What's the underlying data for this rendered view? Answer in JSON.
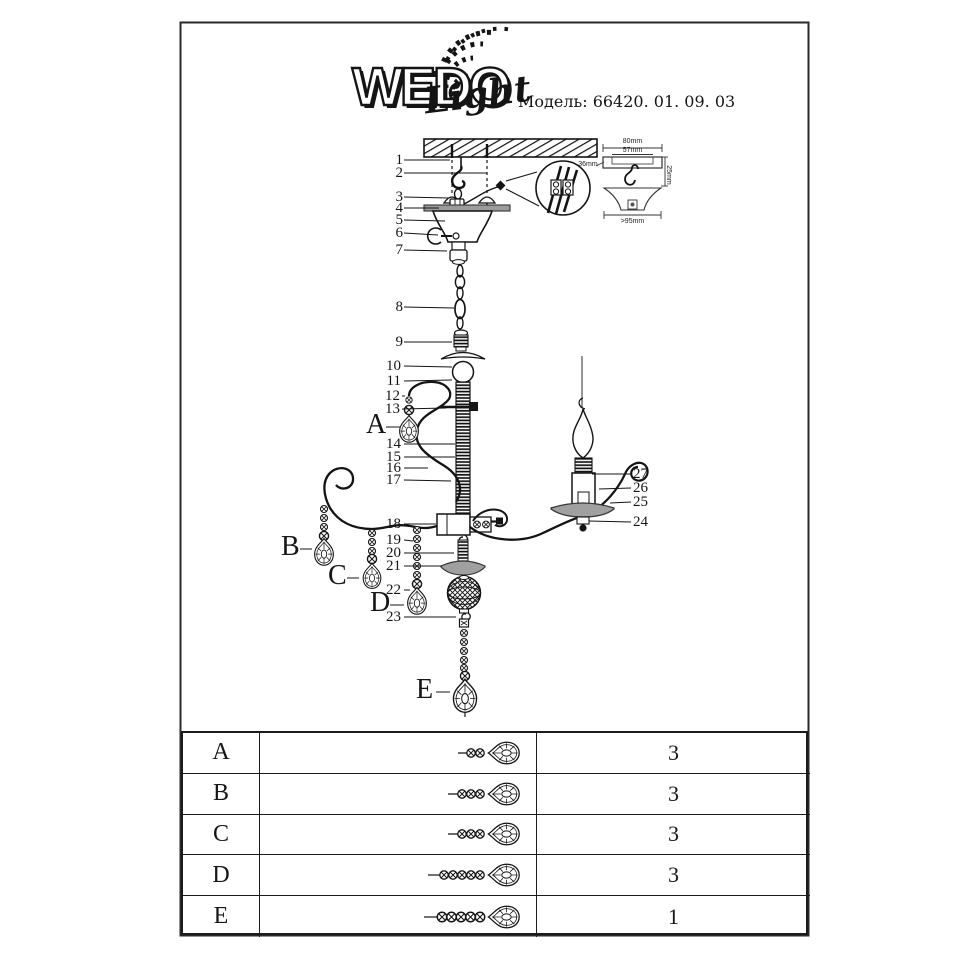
{
  "header": {
    "brand": "WEDO",
    "brand_script": "Light",
    "model": "Модель: 66420. 01. 09. 03"
  },
  "diagram": {
    "callouts": [
      "1",
      "2",
      "3",
      "4",
      "5",
      "6",
      "7",
      "8",
      "9",
      "10",
      "11",
      "12",
      "13",
      "14",
      "15",
      "16",
      "17",
      "18",
      "19",
      "20",
      "21",
      "22",
      "23",
      "24",
      "25",
      "26",
      "27"
    ],
    "letters": [
      "A",
      "B",
      "C",
      "D",
      "E"
    ],
    "inset_dims": [
      "80mm",
      "57mm",
      "36mm",
      "25mm",
      ">95mm"
    ]
  },
  "table": {
    "rows": [
      {
        "item": "A",
        "qty": "3",
        "beads": 2
      },
      {
        "item": "B",
        "qty": "3",
        "beads": 3
      },
      {
        "item": "C",
        "qty": "3",
        "beads": 3
      },
      {
        "item": "D",
        "qty": "3",
        "beads": 5
      },
      {
        "item": "E",
        "qty": "1",
        "beads": 5
      }
    ]
  }
}
